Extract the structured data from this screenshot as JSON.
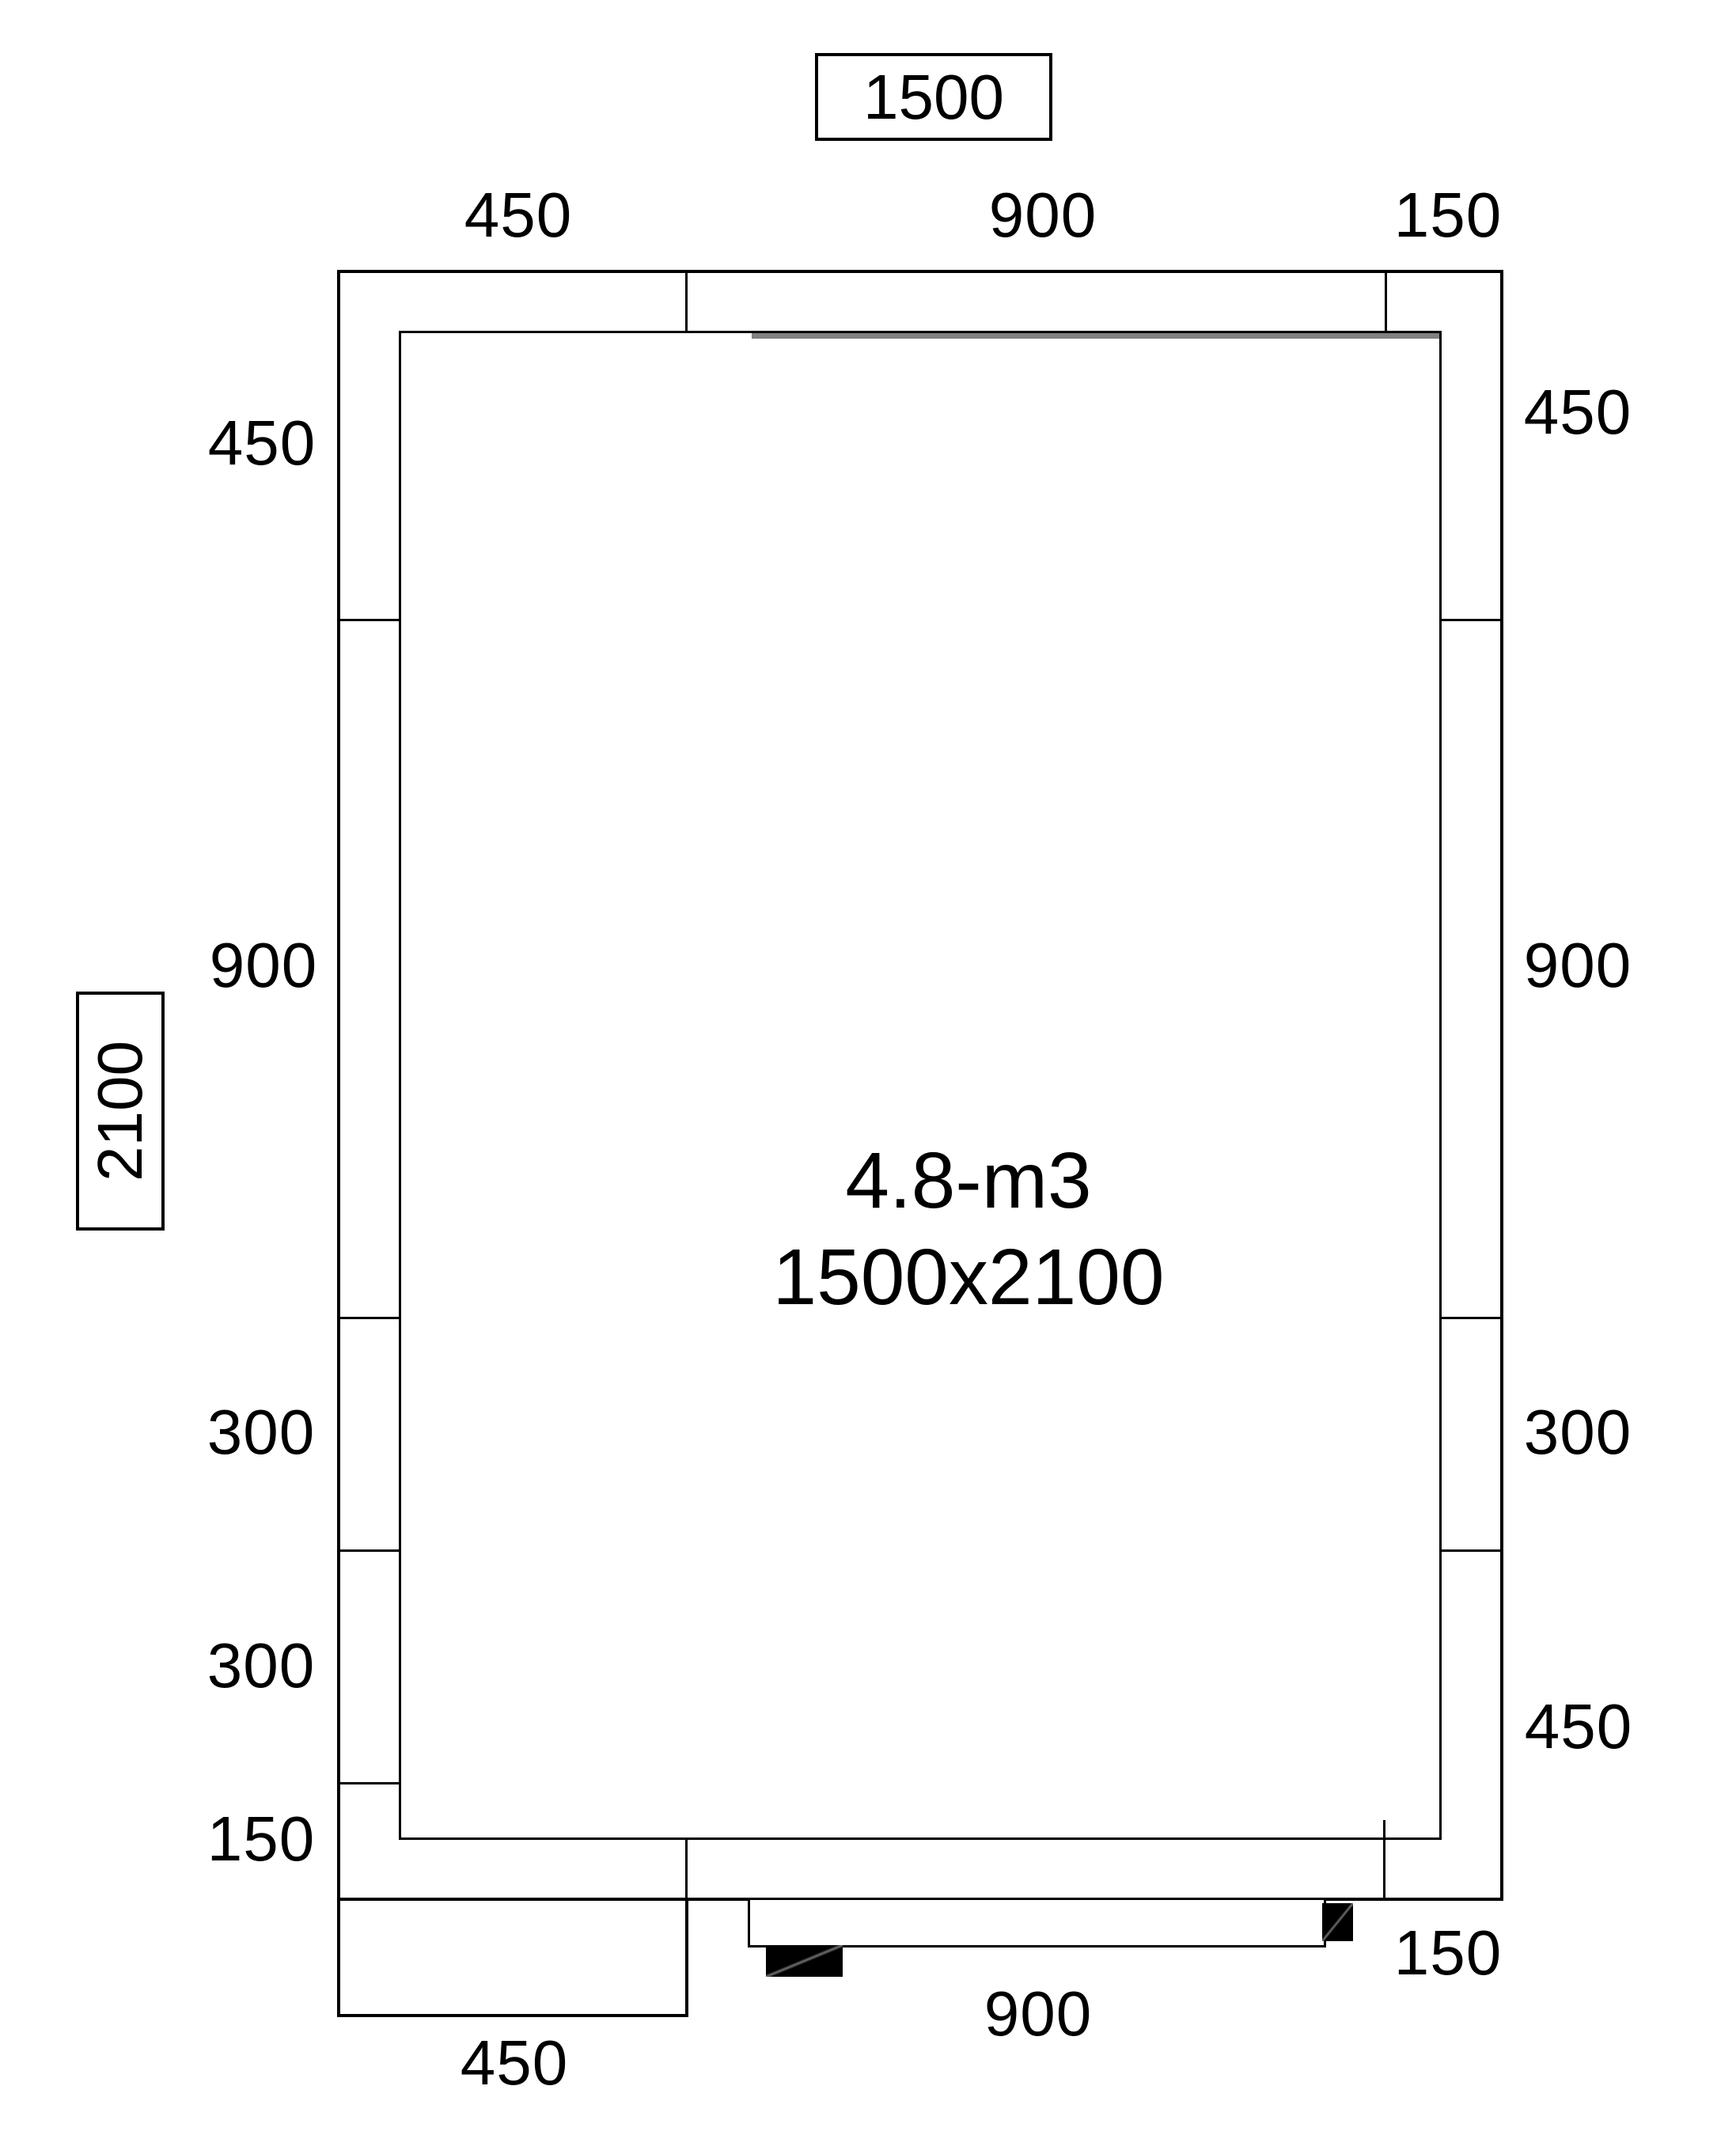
{
  "drawing": {
    "title_volume": "4.8-m3",
    "title_size": "1500x2100",
    "overall_width_label": "1500",
    "overall_height_label": "2100",
    "dimensions": {
      "top": [
        "450",
        "900",
        "150"
      ],
      "left": [
        "450",
        "900",
        "300",
        "300",
        "150"
      ],
      "right": [
        "450",
        "900",
        "300",
        "450"
      ],
      "bottom": [
        "150",
        "900",
        "450"
      ]
    },
    "colors": {
      "line": "#000000",
      "panel_seam": "#808080",
      "door_block": "#000000",
      "background": "#ffffff"
    }
  }
}
